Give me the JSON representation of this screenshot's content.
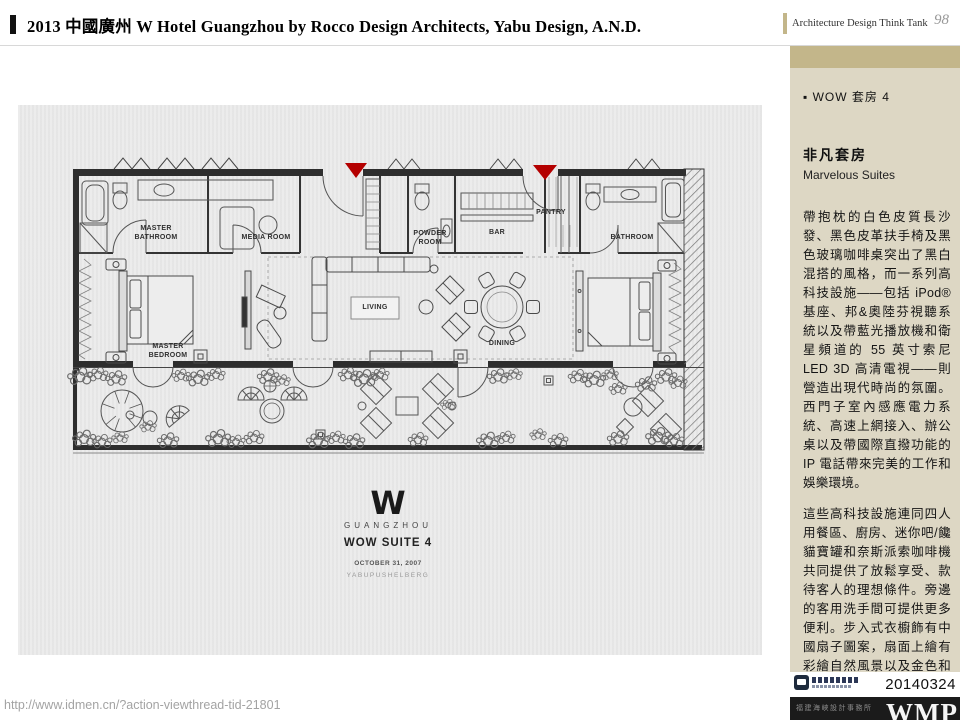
{
  "header": {
    "title": "2013 中國廣州 W Hotel Guangzhou by Rocco Design Architects, Yabu Design, A.N.D.",
    "brand": "Architecture Design Think Tank",
    "page_number": "98"
  },
  "sidebar": {
    "bullet_item": "▪ WOW 套房 4",
    "heading_zh": "非凡套房",
    "heading_en": "Marvelous Suites",
    "paragraph1": "帶抱枕的白色皮質長沙發、黑色皮革扶手椅及黑色玻璃咖啡桌突出了黑白混搭的風格，而一系列高科技設施——包括 iPod® 基座、邦&奧陸芬視聽系統以及帶藍光播放機和衛星頻道的 55 英寸索尼LED 3D 高清電視——則營造出現代時尚的氛圍。西門子室內感應電力系統、高速上網接入、辦公桌以及帶國際直撥功能的IP 電話帶來完美的工作和娛樂環境。",
    "paragraph2": "這些高科技設施連同四人用餐區、廚房、迷你吧/饞貓寶罐和奈斯派索咖啡機共同提供了放鬆享受、款待客人的理想條件。旁邊的客用洗手間可提供更多便利。步入式衣櫥飾有中國扇子圖案，扇面上繪有彩繪自然風景以及金色和黑色的橫切樹木印花。",
    "date": "20140324",
    "studio": "福建海峽設計事務所",
    "wordmark": "WMP"
  },
  "plan": {
    "labels": [
      {
        "id": "master-bathroom",
        "label": "MASTER\nBATHROOM"
      },
      {
        "id": "media-room",
        "label": "MEDIA ROOM"
      },
      {
        "id": "powder-room",
        "label": "POWDER\nROOM"
      },
      {
        "id": "bar",
        "label": "BAR"
      },
      {
        "id": "pantry",
        "label": "PANTRY"
      },
      {
        "id": "bathroom",
        "label": "BATHROOM"
      },
      {
        "id": "master-bedroom",
        "label": "MASTER\nBEDROOM"
      },
      {
        "id": "living",
        "label": "LIVING"
      },
      {
        "id": "dining",
        "label": "DINING"
      }
    ],
    "logo": {
      "mark": "W",
      "city": "GUANGZHOU",
      "suite": "WOW SUITE 4",
      "date": "OCTOBER 31, 2007",
      "credit": "YABUPUSHELBERG"
    }
  },
  "footer": {
    "url": "http://www.idmen.cn/?action-viewthread-tid-21801"
  },
  "colors": {
    "tan_accent": "#c3b68a",
    "sidebar_bg": "#ddd7c4",
    "plan_bg": "#e9e9e9",
    "marker_red": "#b40000",
    "bottom_bar": "#1b1b1b"
  }
}
